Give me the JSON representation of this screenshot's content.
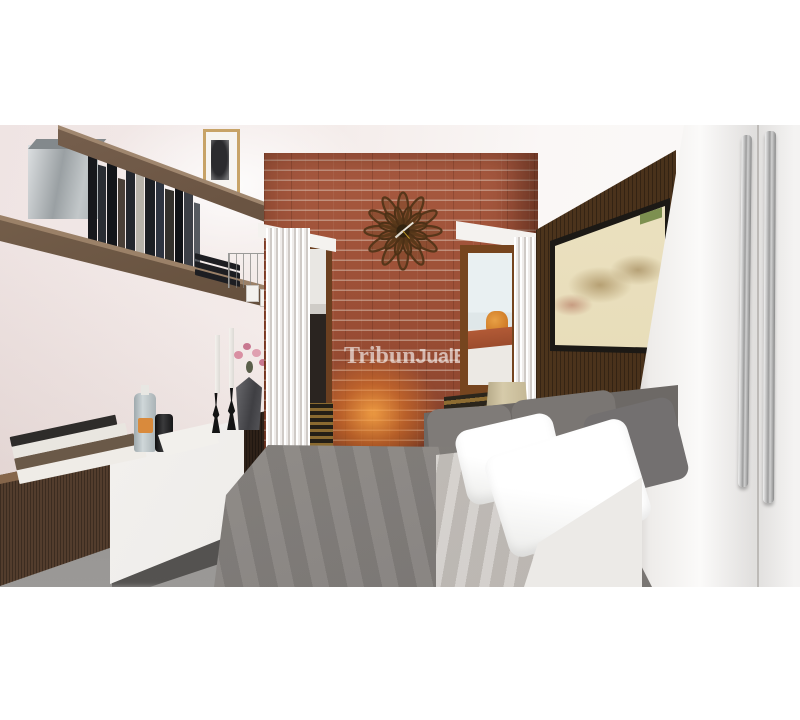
{
  "page": {
    "background": "#ffffff"
  },
  "image": {
    "type": "3d-interior-render",
    "scene": "bedroom with brick accent wall, floating shelves, console, bed and white wardrobe",
    "watermark": {
      "text": "TribunJualBeli",
      "serif_part": "Tribun",
      "bold_part": "JualBeli",
      "color": "#ffffff",
      "opacity": 0.55
    }
  },
  "palette": {
    "wall_pink_white": "#f2e9e8",
    "brick": "#9a4d34",
    "brick_mortar": "#dec9ba",
    "shelf_wood": "#5d4836",
    "console_wood": "#533d2d",
    "drawer_white": "#f6f4f2",
    "headboard_wood": "#54391f",
    "map_cream": "#e7dcb8",
    "map_red": "#c45c50",
    "map_green": "#7d9050",
    "wardrobe_white": "#f7f6f5",
    "handle_chrome": "#9c9c9c",
    "duvet_gray": "#8c8884",
    "pillow_gray": "#7a7673",
    "pillow_white": "#ffffff",
    "sheet_gray": "#c9c4bf",
    "floor_gray": "#8f8d8b",
    "glow_orange": "#e27828",
    "clock_wood": "#5e3c1e",
    "lamp_shade": "#d6cbaa",
    "flower_pink": "#d98fa2",
    "sky": "#e9f0f2",
    "water_tank_orange": "#c9711f",
    "roof_tile": "#b25a36"
  },
  "objects": [
    "floating-shelves",
    "book-collection",
    "metal-storage-box",
    "framed-photo",
    "wire-rack",
    "document-folders",
    "floating-console",
    "stacked-books",
    "glass-bottle",
    "black-canister",
    "paper-tray",
    "candlesticks",
    "geometric-vase",
    "pink-flowers",
    "brick-accent-wall",
    "sunburst-wall-clock",
    "accent-uplight",
    "fluted-columns",
    "left-window",
    "right-window",
    "window-louvers",
    "water-tank-view",
    "wood-headboard-wall",
    "vintage-map-art",
    "table-lamp",
    "bed",
    "gray-pillows",
    "white-pillows",
    "gray-duvet",
    "draped-sheet",
    "white-blanket",
    "white-wardrobe",
    "wardrobe-handles"
  ]
}
